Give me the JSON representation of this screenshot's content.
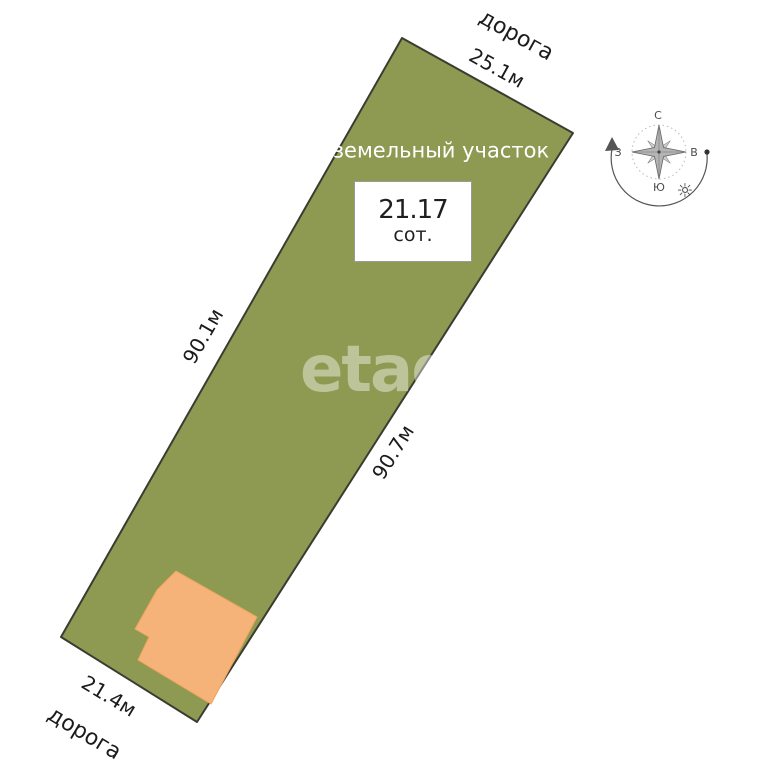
{
  "scene": {
    "plot": {
      "name_label": "земельный участок",
      "area_value": "21.17",
      "area_unit": "сот.",
      "fill": "#8e9a52",
      "road_top": "дорога",
      "dim_top": "25.1м",
      "dim_left": "90.1м",
      "dim_right": "90.7м",
      "dim_bottom": "21.4м",
      "road_bottom": "дорога"
    },
    "building": {
      "fill": "#f5b279"
    },
    "watermark": "etag",
    "compass": {
      "north": "С",
      "south": "Ю",
      "west": "З",
      "east": "В"
    }
  }
}
